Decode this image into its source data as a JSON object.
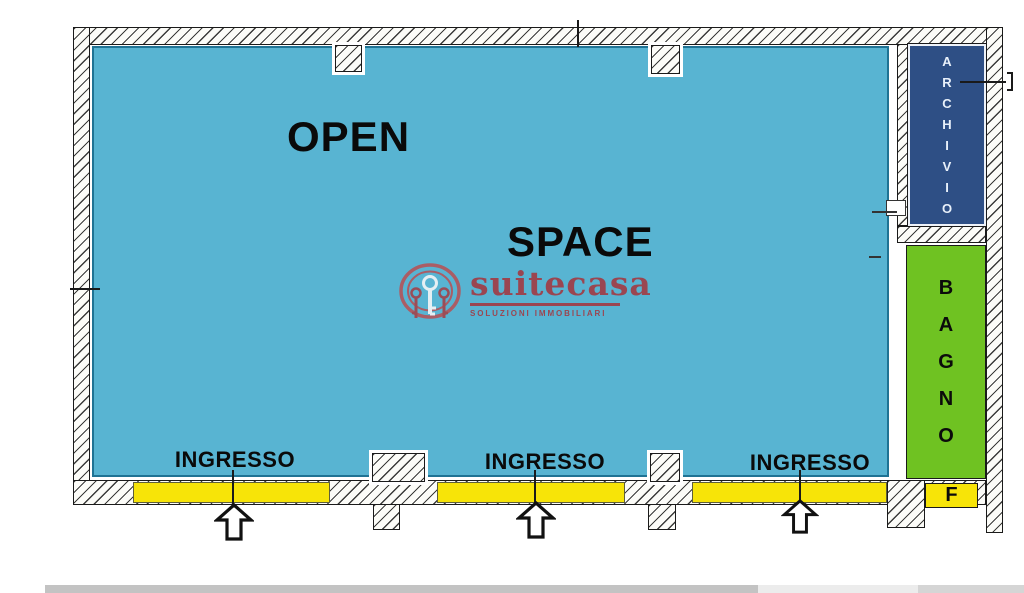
{
  "plan": {
    "open_space": {
      "word1": "OPEN",
      "word2": "SPACE"
    },
    "rooms": {
      "archivio": {
        "name": "ARCHIVIO",
        "letters": [
          "A",
          "R",
          "C",
          "H",
          "I",
          "V",
          "I",
          "O"
        ],
        "fill": "#2e4f85"
      },
      "bagno": {
        "name": "BAGNO",
        "letters": [
          "B",
          "A",
          "G",
          "N",
          "O"
        ],
        "fill": "#6fc222"
      },
      "f": {
        "label": "F",
        "fill": "#f7e408"
      }
    },
    "entrances": [
      {
        "label": "INGRESSO"
      },
      {
        "label": "INGRESSO"
      },
      {
        "label": "INGRESSO"
      }
    ],
    "colors": {
      "open_space_fill": "#58b4d2",
      "open_space_edge": "#1f7394",
      "door_strip_fill": "#f7e408",
      "wall_outline": "#1a1a1a"
    }
  },
  "watermark": {
    "brand": "suitecasa",
    "tagline": "SOLUZIONI IMMOBILIARI",
    "color": "#a03d47"
  }
}
